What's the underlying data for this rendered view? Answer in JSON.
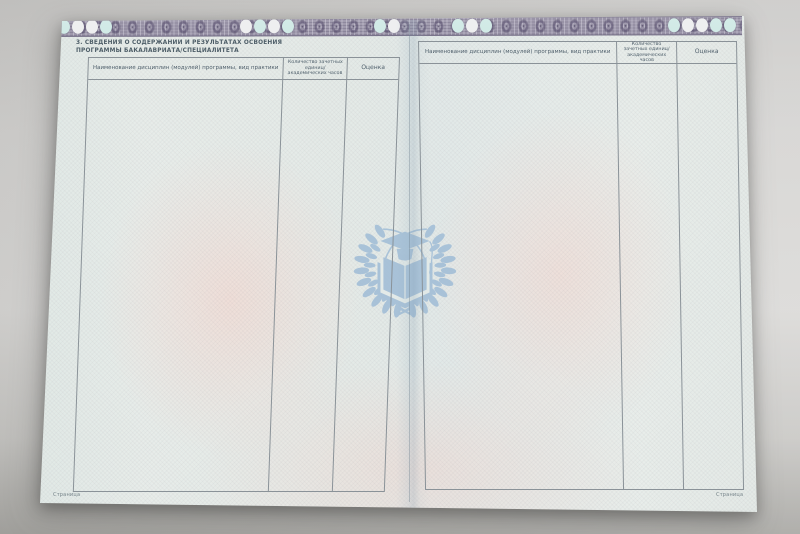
{
  "left_page": {
    "section_title_lines": [
      "3. СВЕДЕНИЯ О СОДЕРЖАНИИ И РЕЗУЛЬТАТАХ ОСВОЕНИЯ",
      "ПРОГРАММЫ БАКАЛАВРИАТА/СПЕЦИАЛИТЕТА"
    ],
    "table": {
      "columns": [
        "Наименование дисциплин (модулей) программы, вид практики",
        "Количество зачетных единиц/ академических часов",
        "Оценка"
      ],
      "rows": []
    },
    "page_footer_label": "Страница"
  },
  "right_page": {
    "table": {
      "columns": [
        "Наименование дисциплин (модулей) программы, вид практики",
        "Количество зачетных единиц/ академических часов",
        "Оценка"
      ],
      "rows": []
    },
    "page_footer_label": "Страница"
  },
  "watermark": {
    "icon": "graduation-cap-open-book-laurel-wreath-emblem",
    "color": "#a4bfd7"
  },
  "security_band": {
    "style": "guilloche",
    "base_color": "#9b95a9",
    "dark_color": "#5e5773",
    "oval_colors": [
      "#cfe9e5",
      "#edeeef"
    ]
  },
  "page_colors": {
    "paper_green_tint": "#e4ebe8",
    "paper_pink_tint": "#f0dcd6",
    "table_border": "#8a9298",
    "text": "#4e5e6a",
    "backdrop": "#d2d1cf"
  }
}
